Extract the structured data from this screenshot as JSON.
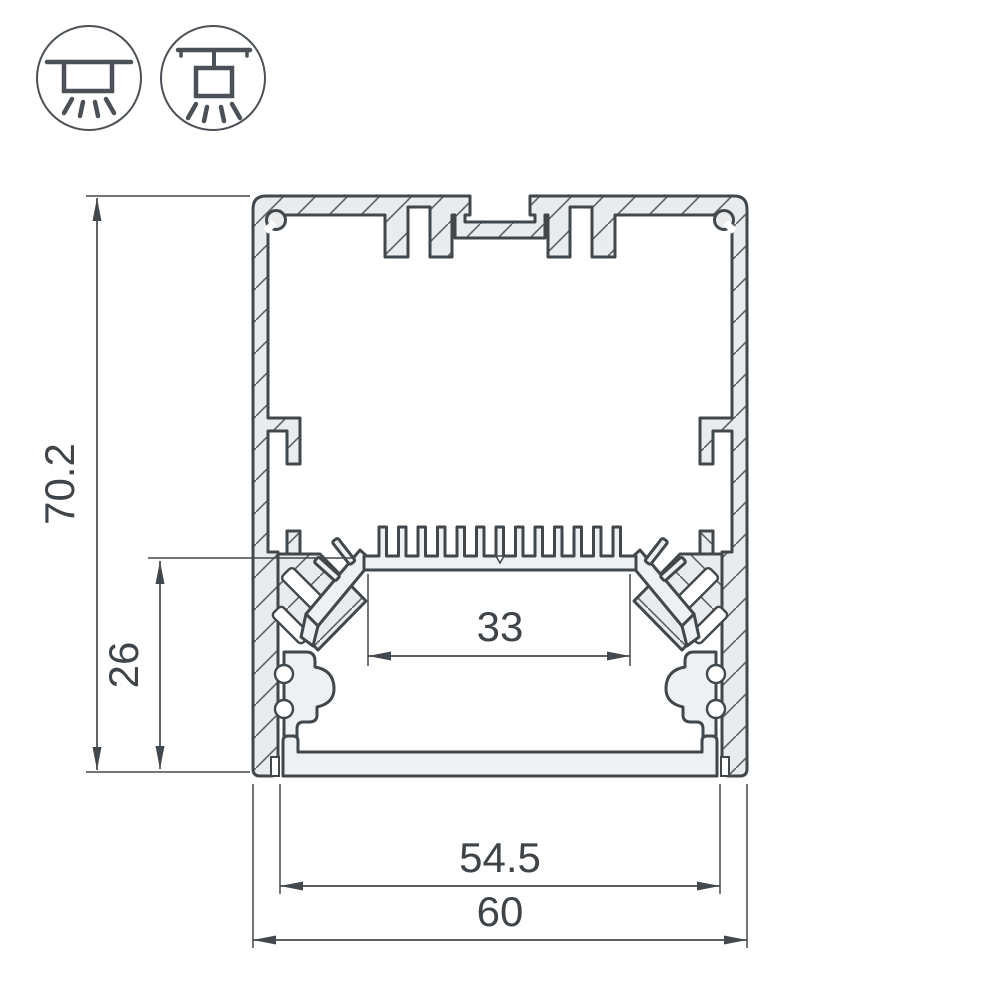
{
  "drawing": {
    "type": "led-aluminum-profile-cross-section",
    "dimensions": {
      "overall_height": "70.2",
      "lower_section_height": "26",
      "led_area_width": "33",
      "inner_width": "54.5",
      "overall_width": "60"
    },
    "colors": {
      "line": "#43484c",
      "aluminum_fill": "#e9ebec",
      "text": "#3f4449",
      "background": "#ffffff"
    }
  },
  "icons": {
    "surface_mount": {
      "name": "surface-mount-light-icon"
    },
    "pendant_mount": {
      "name": "pendant-mount-light-icon"
    }
  }
}
